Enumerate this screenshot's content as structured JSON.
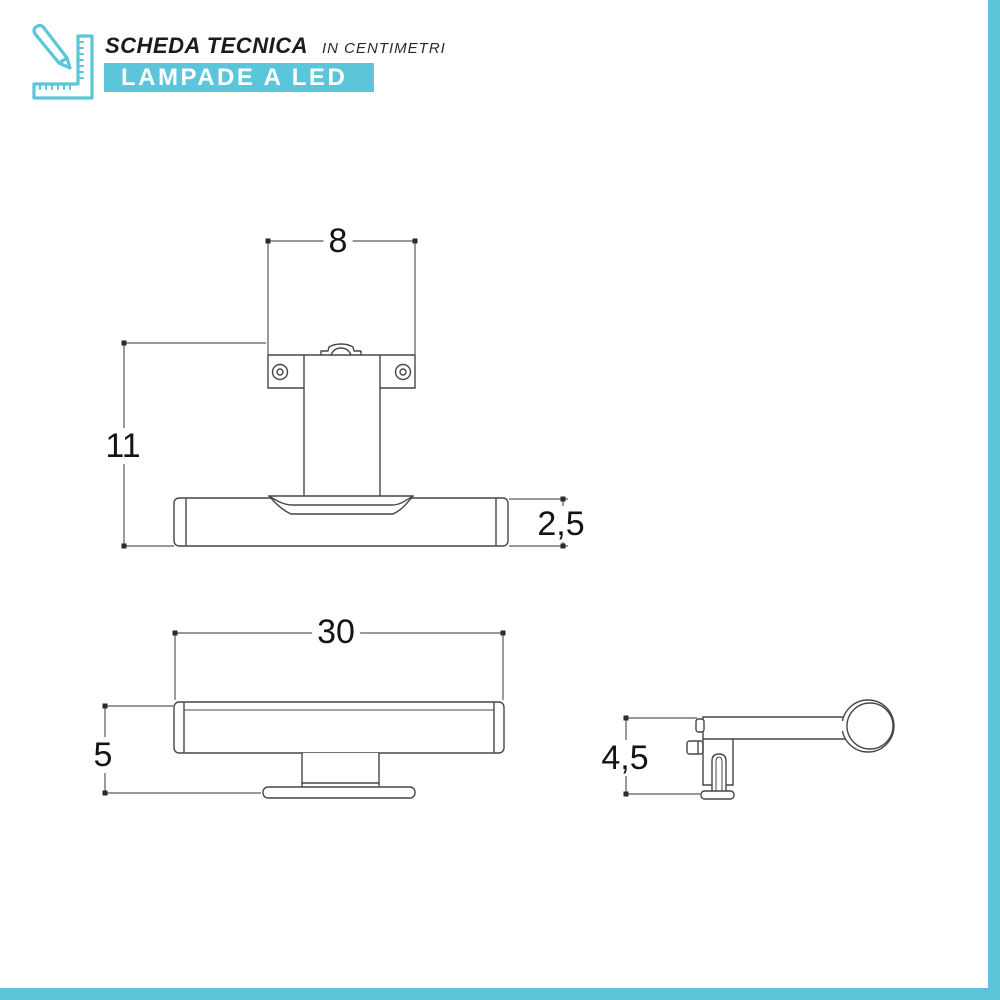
{
  "header": {
    "title": "SCHEDA TECNICA",
    "subtitle": "IN CENTIMETRI",
    "banner": "LAMPADE A LED",
    "icon": "ruler-pencil-icon"
  },
  "dimensions_cm": {
    "front_view_top": {
      "plate_width": "8",
      "overall_height": "11",
      "tube_diameter": "2,5"
    },
    "front_view_bottom": {
      "width": "30",
      "height": "5"
    },
    "side_view": {
      "depth": "4,5"
    }
  },
  "colors": {
    "accent": "#5bc6da",
    "line": "#474747",
    "dim_line": "#5a5a5a",
    "label_text": "#141414"
  }
}
